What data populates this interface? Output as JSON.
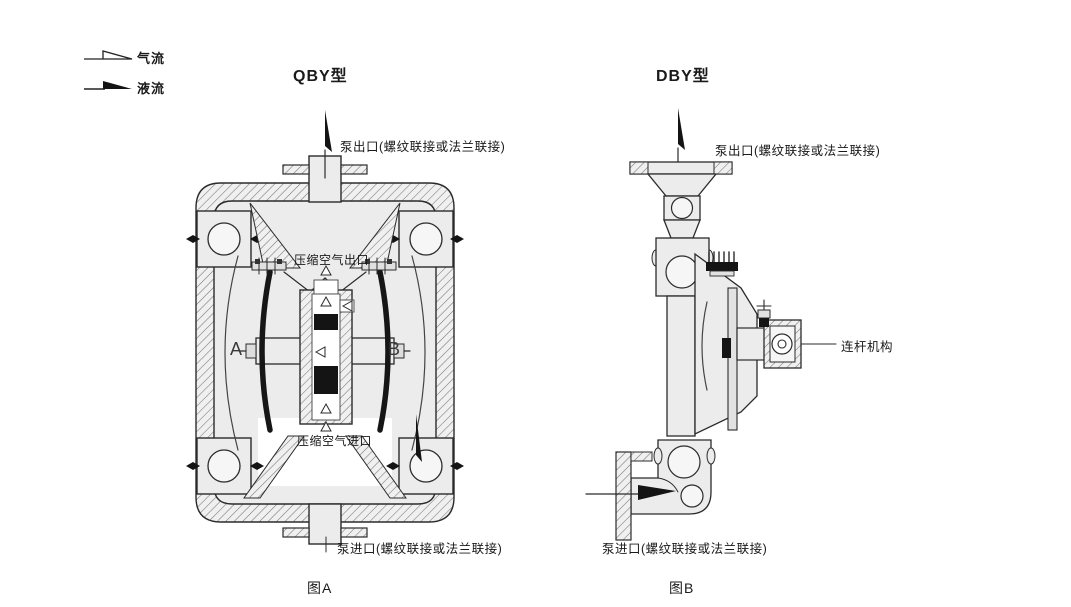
{
  "legend": {
    "air_flow_label": "气流",
    "liquid_flow_label": "液流"
  },
  "qby": {
    "title": "QBY型",
    "outlet_label": "泵出口(螺纹联接或法兰联接)",
    "air_outlet_label": "压缩空气出口",
    "air_inlet_label": "压缩空气进口",
    "chamber_left_label": "A",
    "chamber_right_label": "B",
    "inlet_label": "泵进口(螺纹联接或法兰联接)",
    "caption": "图A"
  },
  "dby": {
    "title": "DBY型",
    "outlet_label": "泵出口(螺纹联接或法兰联接)",
    "rod_label": "连杆机构",
    "inlet_label": "泵进口(螺纹联接或法兰联接)",
    "caption": "图B"
  },
  "colors": {
    "line": "#2b2b2b",
    "body_fill": "#ececec",
    "dark_fill": "#141414",
    "background": "#ffffff"
  }
}
